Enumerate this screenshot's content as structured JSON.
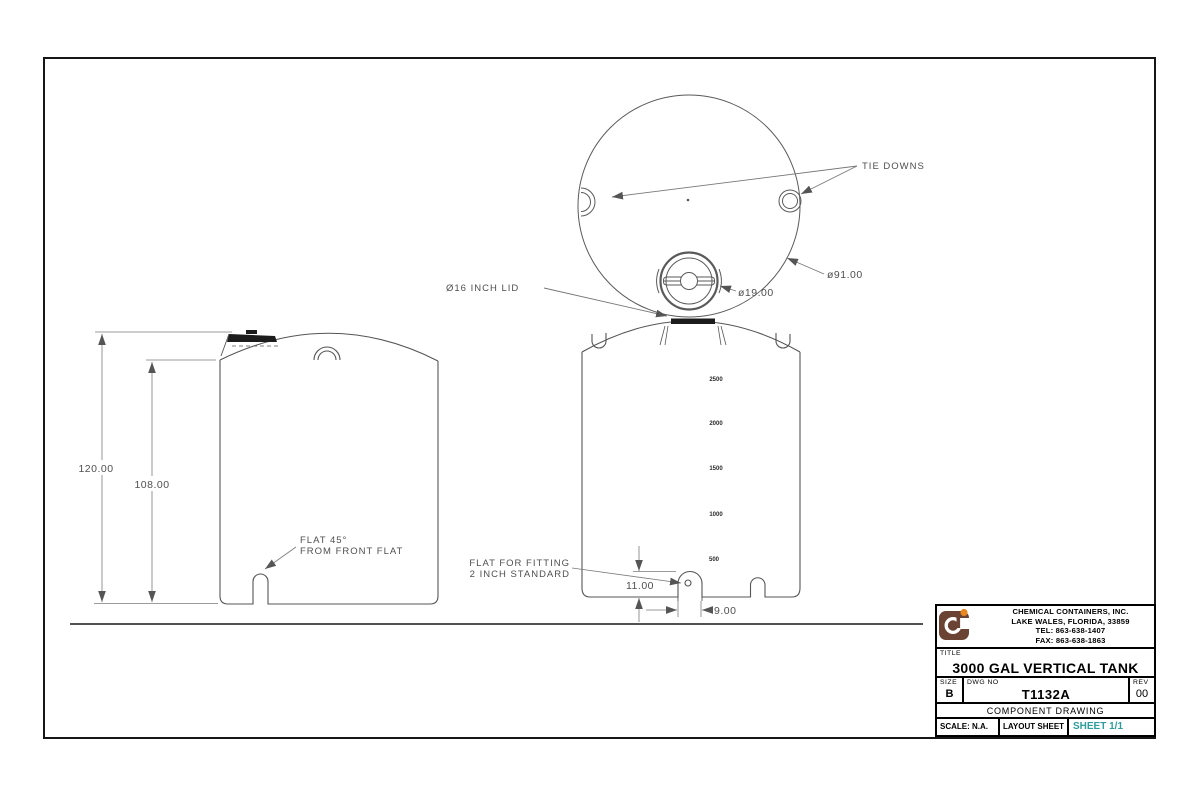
{
  "drawing": {
    "top_view": {
      "tie_downs_label": "TIE DOWNS",
      "outer_dia_label": "ø91.00",
      "lid_dia_label": "ø19.00",
      "lid_label": "Ø16 INCH LID"
    },
    "front_view": {
      "height_overall": "120.00",
      "height_shoulder": "108.00",
      "flat_note_line1": "FLAT 45°",
      "flat_note_line2": "FROM FRONT FLAT"
    },
    "side_view": {
      "gallons": [
        "2500",
        "2000",
        "1500",
        "1000",
        "500"
      ],
      "fitting_note_line1": "FLAT FOR FITTING",
      "fitting_note_line2": "2 INCH STANDARD",
      "fitting_height": "11.00",
      "fitting_offset": "9.00"
    }
  },
  "title_block": {
    "company": {
      "name": "CHEMICAL CONTAINERS, INC.",
      "address": "LAKE WALES, FLORIDA, 33859",
      "tel": "TEL: 863-638-1407",
      "fax": "FAX: 863-638-1863"
    },
    "title_label": "TITLE",
    "title": "3000 GAL VERTICAL TANK",
    "size_label": "SIZE",
    "size": "B",
    "dwg_no_label": "DWG NO",
    "dwg_no": "T1132A",
    "rev_label": "REV",
    "rev": "00",
    "type": "COMPONENT DRAWING",
    "scale": "SCALE: N.A.",
    "layout": "LAYOUT SHEET",
    "sheet": "SHEET 1/1"
  },
  "colors": {
    "line_gray": "#555555",
    "thin_gray": "#7a7a7a",
    "fill_dark": "#1c1c1c",
    "teal": "#2e9c9c",
    "logo_brown": "#6a4334",
    "logo_orange": "#e8871f"
  }
}
